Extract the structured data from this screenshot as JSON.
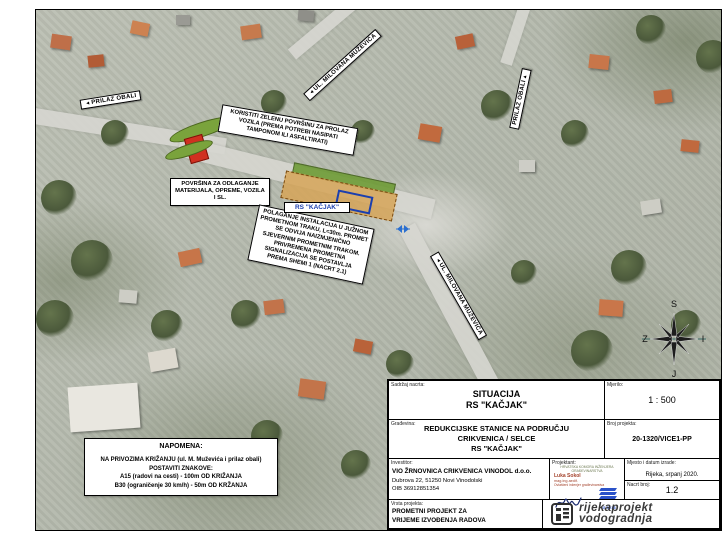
{
  "map": {
    "banners": [
      {
        "arrow": "◄",
        "label": "PRILAZ OBALI"
      },
      {
        "arrow": "◄",
        "label": "UL. MILOVANA MUŽEVIĆA"
      },
      {
        "arrow": "▲",
        "label": "PRILAZ OBALI"
      },
      {
        "arrow": "◄",
        "label": "UL. MILOVANA MUŽEVIĆA"
      }
    ],
    "notes": {
      "green_area": "KORISTITI ZELENU POVRŠINU ZA PROLAZ VOZILA (PREMA POTREBI NASIPATI TAMPONOM ILI ASFALTIRATI)",
      "storage": "POVRŠINA ZA ODLAGANJE MATERIJALA, OPREME, VOZILA I SL.",
      "works": "POLAGANJE INSTALACIJA U JUŽNOM PROMETNOM TRAKU, L=30m. PROMET SE ODVIJA NAIZMJENIČNO SJEVERNIM PROMETNIM TRAKOM. PRIVREMENA PROMETNA SIGNALIZACIJA SE POSTAVLJA PREMA SHEMI 1 (NACRT 2.1)",
      "station_label": "RS \"KAČJAK\""
    },
    "napomena": {
      "title": "NAPOMENA:",
      "line1": "NA PRIVOZIMA KRIŽANJU (ul. M. Muževića i prilaz obali)",
      "line2": "POSTAVITI ZNAKOVE:",
      "line3": "A15 (radovi na cesti) - 100m OD KRIŽANJA",
      "line4": "B30 (ograničenje 30 km/h) - 50m OD KRŽANJA"
    },
    "compass": {
      "n": "S",
      "w": "Z",
      "e": "I",
      "s": "J"
    },
    "colors": {
      "station_label_blue": "#1b3faf",
      "work_zone_orange": "#d6a458",
      "protect_green": "#6f9c37",
      "marker_red": "#d03020"
    }
  },
  "title_block": {
    "sadrzaj": {
      "label": "Sadržaj nacrta:",
      "line1": "SITUACIJA",
      "line2": "RS \"KAČJAK\""
    },
    "mjerilo": {
      "label": "Mjerilo:",
      "value": "1 : 500"
    },
    "gradevina": {
      "label": "Građevina:",
      "line1": "REDUKCIJSKE STANICE NA PODRUČJU",
      "line2": "CRIKVENICA / SELCE",
      "line3": "RS \"KAČJAK\""
    },
    "broj_projekta": {
      "label": "Broj projekta:",
      "value": "20-1320/VICE1-PP"
    },
    "investitor": {
      "label": "Investitor:",
      "line1": "VIO ŽRNOVNICA CRIKVENICA VINODOL d.o.o.",
      "line2": "Dubrova 22, 51250 Novi Vinodolski",
      "line3": "OIB 36912851354"
    },
    "projektant": {
      "label": "Projektant:",
      "chamber": "HRVATSKA KOMORA INŽENJERA GRAĐEVINARSTVA",
      "name": "Luka Sokol",
      "degree": "mag.ing.aedif.",
      "role": "Ovlašteni inženjer građevinarstva",
      "stamp_no": "G 5218"
    },
    "mjesto": {
      "label": "Mjesto i datum izrade:",
      "value": "Rijeka, srpanj 2020."
    },
    "nacrt": {
      "label": "Nacrt broj:",
      "value": "1.2"
    },
    "vrsta": {
      "label": "Vrsta projekta:",
      "line1": "PROMETNI PROJEKT ZA",
      "line2": "VRIJEME IZVOĐENJA RADOVA"
    },
    "company": {
      "line1": "rijekaprojekt",
      "line2": "vodogradnja"
    }
  }
}
